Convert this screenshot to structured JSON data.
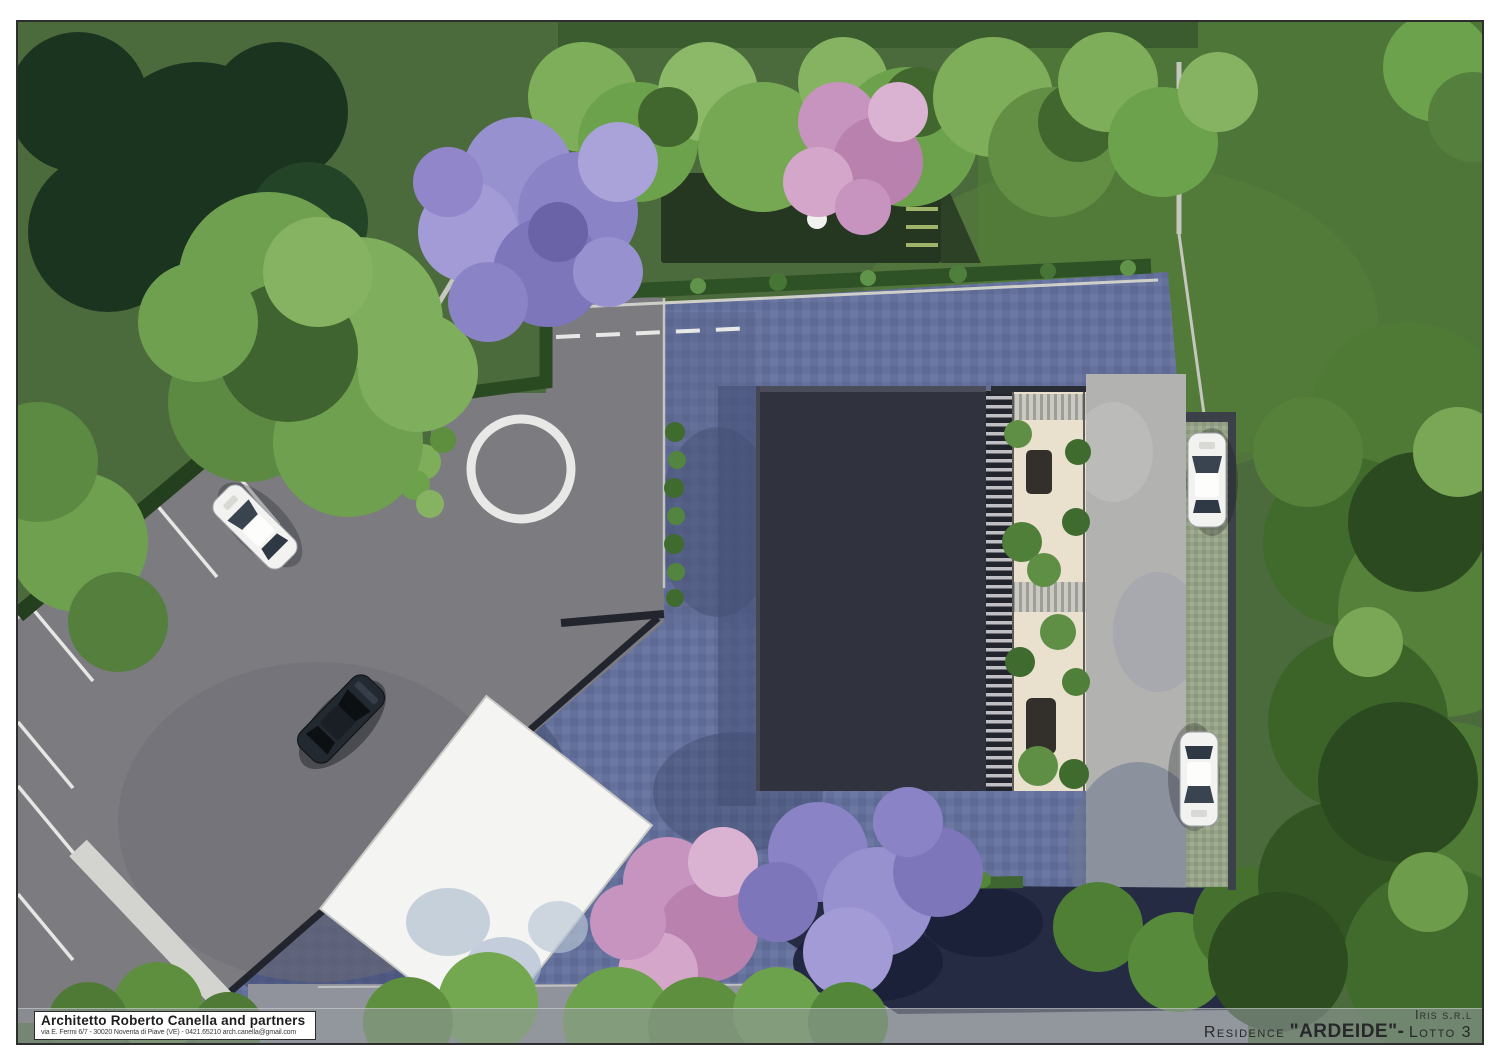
{
  "title_block": {
    "architect": "Architetto Roberto Canella and partners",
    "address": "via E. Fermi 6/7 - 30020 Noventa di Piave (VE) - 0421.65210 arch.canella@gmail.com"
  },
  "project": {
    "client": "Iris s.r.l",
    "residence_label": "Residence",
    "residence_name": "\"ARDEIDE\"-",
    "lot": "Lotto 3"
  },
  "palette": {
    "grass": "#4c6b3c",
    "lawn_bright": "#4f7639",
    "asphalt": "#7b7b80",
    "paver_plaza": "#64719c",
    "paver_plaza_dark": "#3c4668",
    "concrete_path": "#b2b2b0",
    "permeable_paver": "#96a287",
    "building_roof": "#30323e",
    "terrace_deck": "#e9e1cd",
    "white_roof": "#f4f4f2",
    "pond_shadow": "#262b44",
    "tree_green": "#6da24c",
    "tree_dark_green": "#2c4a20",
    "tree_purple": "#8f8ac8",
    "tree_pink": "#c793bf",
    "marking_white": "#e8e8e6"
  }
}
